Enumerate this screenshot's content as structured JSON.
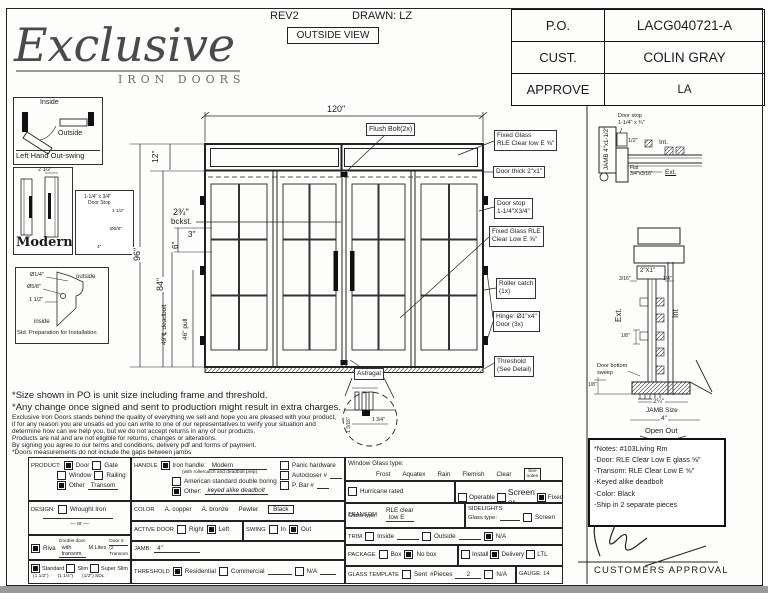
{
  "header": {
    "rev": "REV2",
    "drawn": "DRAWN: LZ",
    "view": "OUTSIDE VIEW",
    "logo": "Exclusive",
    "logo_sub": "IRON DOORS",
    "po_label": "P.O.",
    "po_value": "LACG040721-A",
    "cust_label": "CUST.",
    "cust_value": "COLIN GRAY",
    "approve_label": "APPROVE",
    "approve_value": "LA"
  },
  "sidebar": {
    "swing_inside": "Inside",
    "swing_outside": "Outside",
    "swing_caption": "Left Hand Out-swing",
    "modern_dim": "2 1/2\"",
    "modern_caption": "Modern",
    "stop_l1": "1-1/4\" x 3/4\"",
    "stop_l2": "Door Stop",
    "stop_d1": "1 1/2\"",
    "stop_d2": "Ø5/8\"",
    "stop_d3": "4\"",
    "prep_d1": "Ø1/4\"",
    "prep_d2": "Ø5/8\"",
    "prep_d3": "1 1/2\"",
    "prep_outside": "outside",
    "prep_inside": "inside",
    "prep_caption": "Std. Preparation for Installation"
  },
  "drawing": {
    "dim_w": "120\"",
    "dim_transom": "12\"",
    "dim_total": "96\"",
    "dim_door": "84\"",
    "dim_3": "3\"",
    "dim_6": "6\"",
    "dim_deadbolt": "49\"℄ deadbolt",
    "dim_pull": "46\" pull",
    "bckst1": "2¾\"",
    "bckst2": "bckst.",
    "flush": "Flush Bolt(2x)",
    "fg1a": "Fixed Glass",
    "fg1b": "RLE Clear low E ⅝\"",
    "thick": "Door thick 2\"x1\"",
    "stop1": "Door stop",
    "stop2": "1-1/4\"X3/4\"",
    "fg2a": "Fixed Glass RLE",
    "fg2b": "Clear Low E ⅝\"",
    "roller1": "Roller catch",
    "roller2": "(1x)",
    "hinge1": "Hinge: Ø1\"x4\"",
    "hinge2": "Door (3x)",
    "thr1": "Threshold",
    "thr2": "(See Detail)",
    "astragal": "Astragal",
    "ast_d1": "1 3/16\"",
    "ast_d2": "1 3/4\""
  },
  "details": {
    "jamb": "JAMB 4\"x1-1/2\"",
    "ds1": "Door stop",
    "ds2": "1-1/4\" x ¾\"",
    "half": "1/2\"",
    "int_top": "Int.",
    "flat1": "Flat",
    "flat2": "3/4\"x3/16\"",
    "ext_top": "Ext.",
    "rail": "2\"X1\"",
    "d316": "3/16\"",
    "d14": "1/4\"",
    "ext": "Ext.",
    "int": "Int",
    "d18": "1/8\"",
    "sweep1": "Door bottom",
    "sweep2": "sweep",
    "d18b": "1/8\"",
    "j1": "2¼\"",
    "j2": "JAMB Size",
    "j3": "4\"",
    "open": "Open Out",
    "approval": "CUSTOMERS APPROVAL"
  },
  "notes": {
    "lines": [
      "*Notes: #103Living Rm",
      "-Door: RLE Clear Low E glass ⅝\"",
      "-Transom: RLE Clear Low E ⅝\"",
      "-Keyed alike deadbolt",
      "-Color: Black",
      "-Ship in 2 separate pieces"
    ]
  },
  "disclaimer": {
    "l1": "*Size shown in PO is unit size including frame and threshold.",
    "l2": "*Any change once signed and sent to production might result in extra charges.",
    "s1": "Exclusive Iron Doors stands behind the quality of everything we sell and hope you are pleased with your product,",
    "s2": "if for any reason you are unsatis ed you can write to one of our representatives to verify your situation and",
    "s3": "determine how can we help you, but we do not accept returns in any of our products.",
    "s4": "Products are  nal and are not eligible for returns, changes or alterations.",
    "s5": "By signing you agree to our terms and conditions, delivery pdf and forms of payment.",
    "s6": "*Doors measurements do not include the gaps between jambs"
  },
  "form": {
    "product": {
      "label": "PRODUCT:",
      "door": true,
      "door_l": "Door",
      "gate": false,
      "gate_l": "Gate",
      "window": false,
      "window_l": "Window",
      "railing": false,
      "railing_l": "Railing",
      "other": true,
      "other_l": "Other",
      "other_v": "Transom"
    },
    "design": {
      "label": "DESIGN:",
      "wrought": false,
      "wrought_l": "Wrought Iron",
      "or": "or"
    },
    "riva": {
      "checked": true,
      "label": "Riva",
      "note": "Double door",
      "value": "with transom",
      "mlites_l": "M.Lites",
      "mlites_v1": "Door 6",
      "mlites_v2": "(2 Transom"
    },
    "widths": {
      "standard": true,
      "standard_l": "Standard",
      "standard_s": "(1 1/2\")",
      "slim": false,
      "slim_l": "Slim",
      "slim_s": "(1 1/4\")",
      "superslim": false,
      "superslim_l": "Super Slim",
      "superslim_s": "(1/2\") SDL"
    },
    "handle": {
      "label": "HANDLE",
      "iron": true,
      "iron_l": "Iron handle:",
      "iron_v": "Modern",
      "iron_note": "(with rollercatch and deadbolt prep)",
      "american": false,
      "american_l": "American standard double boring",
      "other": true,
      "other_l": "Other:",
      "other_v": "keyed alike deadbolt",
      "panic": false,
      "panic_l": "Panic hardware",
      "auto": false,
      "auto_l": "Autocloser #",
      "pbar": false,
      "pbar_l": "P. Bar #"
    },
    "color": {
      "label": "COLOR",
      "o1": "A. copper",
      "o2": "A. bronze",
      "o3": "Pewter",
      "selected": "Black"
    },
    "active": {
      "label": "ACTIVE DOOR",
      "right": false,
      "right_l": "Right",
      "left": true,
      "left_l": "Left"
    },
    "swing": {
      "label": "SWING",
      "in": false,
      "in_l": "In",
      "out": true,
      "out_l": "Out"
    },
    "jamb": {
      "label": "JAMB:",
      "value": "4\""
    },
    "threshold": {
      "label": "THRESHOLD",
      "res": true,
      "res_l": "Residential",
      "com": false,
      "com_l": "Commercial",
      "na": false,
      "na_l": "N/A"
    },
    "window_glass": {
      "label": "Window Glass type:",
      "o1": "Frost",
      "o2": "Aquatex",
      "o3": "Rain",
      "o4": "Flemish",
      "o5": "Clear",
      "see1": "See",
      "see2": "notes"
    },
    "hurricane": {
      "checked": false,
      "label": "Hurricane rated"
    },
    "op": {
      "operable": false,
      "operable_l": "Operable",
      "screen": false,
      "screen_l": "Screen or",
      "fixed": true,
      "fixed_l": "Fixed"
    },
    "transom_glass": {
      "l1": "TRANSOM",
      "l2": "Glass type:",
      "v1": "RLE clear",
      "v2": "low E"
    },
    "sidelights": {
      "l1": "SIDELIGHTS",
      "l2": "Glass type:",
      "screen": false,
      "screen_l": "Screen"
    },
    "trim": {
      "label": "TRIM",
      "inside": false,
      "inside_l": "Inside",
      "outside": false,
      "outside_l": "Outside",
      "na": true,
      "na_l": "N/A"
    },
    "package": {
      "label": "PACKAGE",
      "box": false,
      "box_l": "Box",
      "nobox": true,
      "nobox_l": "No box",
      "install": false,
      "install_l": "Install",
      "delivery": true,
      "delivery_l": "Delivery",
      "ltl": false,
      "ltl_l": "LTL"
    },
    "glass_template": {
      "label": "GLASS TEMPLATE",
      "sent": false,
      "sent_l": "Sent",
      "pieces_l": "#Pieces",
      "pieces_v": "2",
      "na": false,
      "na_l": "N/A"
    },
    "gauge": "GAUGE: 14"
  }
}
